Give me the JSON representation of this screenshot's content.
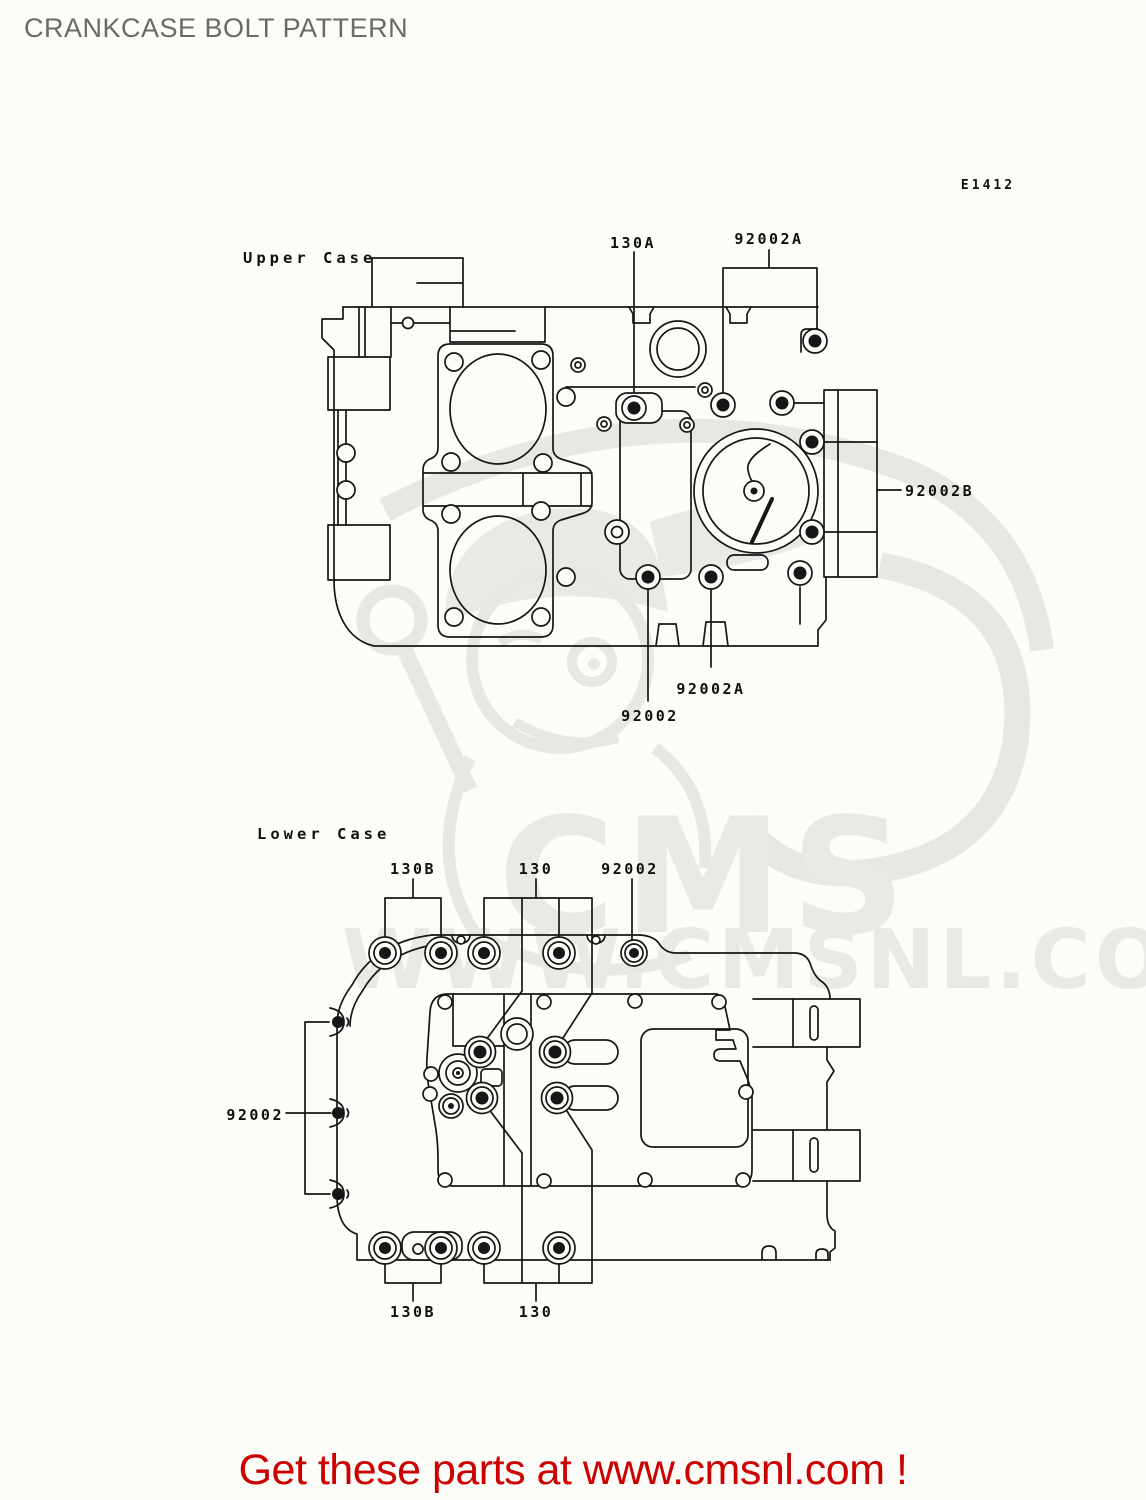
{
  "page": {
    "title": "CRANKCASE BOLT PATTERN",
    "diagram_code": "E1412"
  },
  "footer": {
    "text": "Get these parts at www.cmsnl.com !",
    "color": "#cc0000"
  },
  "watermark": {
    "brand": "CMS",
    "url": "WWW.CMSNL.COM",
    "color": "#e9e9e5"
  },
  "upper_case": {
    "section_label": "Upper Case",
    "callouts": [
      {
        "id": "130A-top",
        "text": "130A"
      },
      {
        "id": "92002A-top",
        "text": "92002A"
      },
      {
        "id": "92002B-right",
        "text": "92002B"
      },
      {
        "id": "92002A-bottom",
        "text": "92002A"
      },
      {
        "id": "92002-bottom",
        "text": "92002"
      }
    ]
  },
  "lower_case": {
    "section_label": "Lower Case",
    "callouts": [
      {
        "id": "130B-top",
        "text": "130B"
      },
      {
        "id": "130-top",
        "text": "130"
      },
      {
        "id": "92002-top",
        "text": "92002"
      },
      {
        "id": "92002-left",
        "text": "92002"
      },
      {
        "id": "130B-bottom",
        "text": "130B"
      },
      {
        "id": "130-bottom",
        "text": "130"
      }
    ]
  }
}
